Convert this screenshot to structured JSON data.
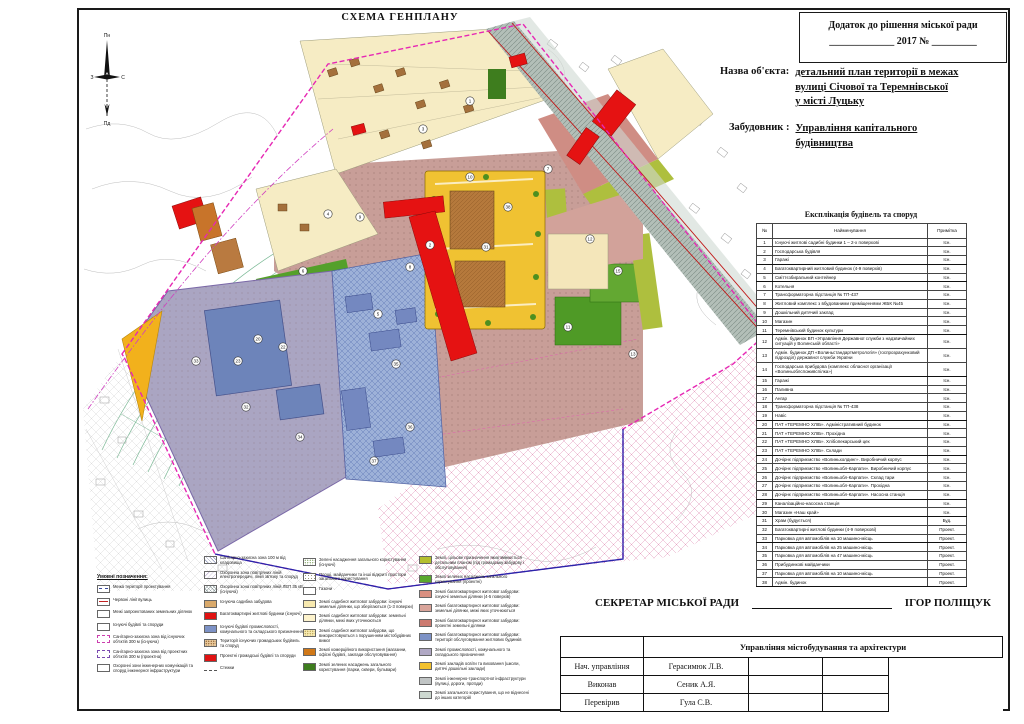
{
  "page_title": "СХЕМА ГЕНПЛАНУ",
  "annex": {
    "line1": "Додаток до рішення міської ради",
    "line2": "_____________ 2017  № _________"
  },
  "object": {
    "label": "Назва об'єкта:",
    "lines": [
      "детальний план території в межах",
      "вулиці Січової та Теремнівської",
      "у місті Луцьку"
    ]
  },
  "developer": {
    "label": "Забудовник :",
    "lines": [
      "Управління капітального",
      "будівництва"
    ]
  },
  "compass": {
    "north": "Пн",
    "south": "Пд",
    "west": "З",
    "east": "С"
  },
  "explication": {
    "title": "Експлікація будівель та споруд",
    "headers": [
      "№",
      "Найменування",
      "Примітка"
    ],
    "rows": [
      {
        "n": "1",
        "name": "Існуючі житлові садибні будинки 1 – 2-х поверхові",
        "note": "Існ."
      },
      {
        "n": "2",
        "name": "Господарська будівля",
        "note": "Існ."
      },
      {
        "n": "3",
        "name": "Гаражі",
        "note": "Існ."
      },
      {
        "n": "4",
        "name": "Багатоквартирний житловий будинок (4-9 поверхів)",
        "note": "Існ."
      },
      {
        "n": "5",
        "name": "Сміттєзбиральний контейнер",
        "note": "Існ."
      },
      {
        "n": "6",
        "name": "Котельня",
        "note": "Існ."
      },
      {
        "n": "7",
        "name": "Трансформаторна підстанція № ТП-437",
        "note": "Існ."
      },
      {
        "n": "8",
        "name": "Житловий комплекс з вбудованими приміщеннями ЖБК №45",
        "note": "Існ."
      },
      {
        "n": "9",
        "name": "Дошкільний дитячий заклад",
        "note": "Існ."
      },
      {
        "n": "10",
        "name": "Магазин",
        "note": "Існ."
      },
      {
        "n": "11",
        "name": "Теремнівський будинок культури",
        "note": "Існ."
      },
      {
        "n": "12",
        "name": "Адмін. будинок ВП «Управління Державної служби з надзвичайних ситуацій у Волинській області»",
        "note": "Існ."
      },
      {
        "n": "13",
        "name": "Адмін. будинок ДП «Волиньстандартметрологія» (госпрозрахунковий підрозділ) державної служби України",
        "note": "Існ."
      },
      {
        "n": "14",
        "name": "Господарська прибудова (комплекс обласної організації «Волиньоблспоживспілка»)",
        "note": "Існ."
      },
      {
        "n": "15",
        "name": "Гаражі",
        "note": "Існ."
      },
      {
        "n": "16",
        "name": "Паливна",
        "note": "Існ."
      },
      {
        "n": "17",
        "name": "Ангар",
        "note": "Існ."
      },
      {
        "n": "18",
        "name": "Трансформаторна підстанція № ТП-438",
        "note": "Існ."
      },
      {
        "n": "19",
        "name": "Навіс",
        "note": "Існ."
      },
      {
        "n": "20",
        "name": "ПАТ «ТЕРЕМНО ХЛІБ». Адміністративний будинок",
        "note": "Існ."
      },
      {
        "n": "21",
        "name": "ПАТ «ТЕРЕМНО ХЛІБ». Прохідна",
        "note": "Існ."
      },
      {
        "n": "22",
        "name": "ПАТ «ТЕРЕМНО ХЛІБ». Хлібопекарський цех",
        "note": "Існ."
      },
      {
        "n": "23",
        "name": "ПАТ «ТЕРЕМНО ХЛІБ». Склади",
        "note": "Існ."
      },
      {
        "n": "24",
        "name": "Дочірнє підприємство «Волиньхолдинг». Виробничий корпус",
        "note": "Існ."
      },
      {
        "n": "25",
        "name": "Дочірнє підприємство «Волиньобл-Карпати». Виробничий корпус",
        "note": "Існ."
      },
      {
        "n": "26",
        "name": "Дочірнє підприємство «Волиньобл-Карпати». Склад тари",
        "note": "Існ."
      },
      {
        "n": "27",
        "name": "Дочірнє підприємство «Волиньобл-Карпати». Прохідна",
        "note": "Існ."
      },
      {
        "n": "28",
        "name": "Дочірнє підприємство «Волиньобл-Карпати». Насосна станція",
        "note": "Існ."
      },
      {
        "n": "29",
        "name": "Каналізаційно-насосна станція",
        "note": "Існ."
      },
      {
        "n": "30",
        "name": "Магазин «Наш край»",
        "note": "Існ."
      },
      {
        "n": "31",
        "name": "Храм (будується)",
        "note": "Буд."
      },
      {
        "n": "32",
        "name": "Багатоквартирні житлові будинки (4-9 поверхові)",
        "note": "Проект."
      },
      {
        "n": "33",
        "name": "Парковка для автомобілів на 10 машино-місць",
        "note": "Проект."
      },
      {
        "n": "34",
        "name": "Парковка для автомобілів на 25 машино-місць",
        "note": "Проект."
      },
      {
        "n": "35",
        "name": "Парковка для автомобілів на 47 машино-місць",
        "note": "Проект."
      },
      {
        "n": "36",
        "name": "Прибудинкові майданчики",
        "note": "Проект."
      },
      {
        "n": "37",
        "name": "Парковка для автомобілів на 10 машино-місць",
        "note": "Проект."
      },
      {
        "n": "38",
        "name": "Адмін. будинок",
        "note": "Проект."
      }
    ]
  },
  "legend": {
    "columns": [
      {
        "header": "Умовні позначення:",
        "items": [
          {
            "sw": "line-blue",
            "label": "Межа території проектування"
          },
          {
            "sw": "line-red",
            "label": "Червоні лінії вулиць"
          },
          {
            "sw": "white",
            "label": "Межі запроектованих земельних ділянок"
          },
          {
            "sw": "white",
            "label": "Існуючі будівлі та споруди"
          },
          {
            "sw": "dash-mag",
            "label": "Санітарно-захисна зона від існуючих об'єктів 300 м (існуюча)"
          },
          {
            "sw": "dash-pur",
            "label": "Санітарно-захисна зона від проектних об'єктів 300 м (проектна)"
          },
          {
            "sw": "white",
            "label": "Охоронні зони інженерних комунікацій та споруд інженерної інфраструктури"
          }
        ]
      },
      {
        "header": "",
        "items": [
          {
            "sw": "hx",
            "label": "Санітарно-захисна зона 100 м від кладовища"
          },
          {
            "sw": "hl",
            "label": "Охоронна зона повітряних ліній електропередачі, ліній зв'язку та споруд"
          },
          {
            "sw": "hx2",
            "label": "Охоронна зона повітряних ліній ЛЕП 35 кВ (існуюча)"
          },
          {
            "sw": "tan",
            "label": "Існуюча садибна забудова"
          },
          {
            "sw": "red",
            "label": "Багатоквартирні житлові будинки (існуючі)"
          },
          {
            "sw": "blue2",
            "label": "Існуючі будівлі промисловості, комунального та складського призначення"
          },
          {
            "sw": "tan-dots",
            "label": "Території існуючих громадських будівель та споруд"
          },
          {
            "sw": "red2",
            "label": "Проектні громадські будівлі та споруди"
          },
          {
            "sw": "dashes",
            "label": "Стежки"
          }
        ]
      },
      {
        "header": "",
        "items": [
          {
            "sw": "dots-grn",
            "label": "Зелені насадження загального користування (існуючі)"
          },
          {
            "sw": "dots-grn2",
            "label": "Площі, майданчики та інші відкриті простори загального користування"
          },
          {
            "sw": "white",
            "label": "Газони"
          },
          {
            "sw": "py",
            "label": "Землі садибної житлової забудови: існуючі земельні ділянки, що зберігаються (1-3 поверхи)"
          },
          {
            "sw": "py2",
            "label": "Землі садибної житлової забудови: земельні ділянки, межі яких уточнюються"
          },
          {
            "sw": "py-dots",
            "label": "Землі садибної житлової забудови, що використовуються з порушенням містобудівних вимог"
          },
          {
            "sw": "orange",
            "label": "Землі комерційного використання (магазини, офісні будівлі, заклади обслуговування)"
          },
          {
            "sw": "dkgreen",
            "label": "Землі зелених насаджень загального користування (парки, сквери, бульвари)"
          }
        ]
      },
      {
        "header": "",
        "items": [
          {
            "sw": "olive",
            "label": "Землі, цільове призначення яких змінюється детальним планом (під громадську забудову і обслуговування)"
          },
          {
            "sw": "green",
            "label": "Землі зелених насаджень загального користування (проектні)"
          },
          {
            "sw": "salmon",
            "label": "Землі багатоквартирної житлової забудови: існуючі земельні ділянки (4-5 поверхів)"
          },
          {
            "sw": "pink",
            "label": "Землі багатоквартирної житлової забудови: земельні ділянки, межі яких уточнюються"
          },
          {
            "sw": "rose",
            "label": "Землі багатоквартирної житлової забудови: проектні земельні ділянки"
          },
          {
            "sw": "blue",
            "label": "Землі багатоквартирної житлової забудови: території обслуговування житлових будинків"
          },
          {
            "sw": "lav",
            "label": "Землі промисловості, комунального та складського призначення"
          },
          {
            "sw": "gold",
            "label": "Землі закладів освіти та виховання (школи, дитячі дошкільні заклади)"
          },
          {
            "sw": "gray",
            "label": "Землі інженерно-транспортної інфраструктури (вулиці, дороги, проїзди)"
          },
          {
            "sw": "graygreen",
            "label": "Землі загального користування, що не віднесені до інших категорій"
          }
        ]
      }
    ]
  },
  "secretary": {
    "label": "СЕКРЕТАР МІСЬКОЇ РАДИ",
    "name": "ІГОР ПОЛІЩУК"
  },
  "stamp": {
    "title": "Управління містобудування та архітектури",
    "rows": [
      [
        "Нач. управління",
        "Герасимюк Л.В."
      ],
      [
        "Виконав",
        "Сеник А.Я."
      ],
      [
        "Перевірив",
        "Гула С.В."
      ]
    ]
  },
  "map": {
    "palette": {
      "road_gray": "#b3bfb8",
      "site_mauve": "#c89e98",
      "school_yellow": "#f0c232",
      "red_building": "#e51212",
      "industry_lavender": "#aaa5c2",
      "blue_building": "#6d84ba",
      "residential_blue": "#9db1d8",
      "green": "#4f9a26",
      "olive": "#aebf3e",
      "cream_parcel": "#f6ecc4",
      "boundary_magenta": "#e628b4",
      "szz_green": "#79b894",
      "pink_hatch": "#e08ab2",
      "orange_building": "#c8742a",
      "yellow_wedge": "#f2b11c"
    },
    "labels": [
      {
        "n": "1",
        "x": 392,
        "y": 92
      },
      {
        "n": "3",
        "x": 345,
        "y": 120
      },
      {
        "n": "4",
        "x": 250,
        "y": 205
      },
      {
        "n": "6",
        "x": 225,
        "y": 262
      },
      {
        "n": "9",
        "x": 282,
        "y": 208
      },
      {
        "n": "10",
        "x": 392,
        "y": 168
      },
      {
        "n": "38",
        "x": 430,
        "y": 198
      },
      {
        "n": "31",
        "x": 408,
        "y": 238
      },
      {
        "n": "2",
        "x": 352,
        "y": 236
      },
      {
        "n": "8",
        "x": 332,
        "y": 258
      },
      {
        "n": "7",
        "x": 470,
        "y": 160
      },
      {
        "n": "12",
        "x": 512,
        "y": 230
      },
      {
        "n": "15",
        "x": 540,
        "y": 262
      },
      {
        "n": "5",
        "x": 300,
        "y": 305
      },
      {
        "n": "20",
        "x": 180,
        "y": 330
      },
      {
        "n": "22",
        "x": 205,
        "y": 338
      },
      {
        "n": "23",
        "x": 160,
        "y": 352
      },
      {
        "n": "33",
        "x": 118,
        "y": 352
      },
      {
        "n": "32",
        "x": 168,
        "y": 398
      },
      {
        "n": "34",
        "x": 222,
        "y": 428
      },
      {
        "n": "35",
        "x": 318,
        "y": 355
      },
      {
        "n": "36",
        "x": 332,
        "y": 418
      },
      {
        "n": "37",
        "x": 296,
        "y": 452
      },
      {
        "n": "11",
        "x": 490,
        "y": 318
      },
      {
        "n": "13",
        "x": 555,
        "y": 345
      }
    ]
  }
}
